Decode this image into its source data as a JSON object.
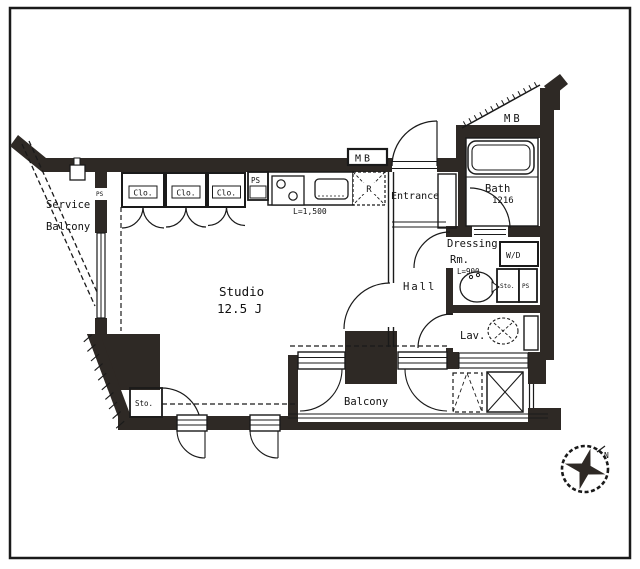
{
  "plan": {
    "labels": {
      "service_line1": "Service",
      "service_line2": "Balcony",
      "closet": "Clo.",
      "pipe_space": "PS",
      "meter_box": "MB",
      "kitchen_length": "L=1,500",
      "refrigerator": "R",
      "entrance": "Entrance",
      "bath": "Bath",
      "bath_size": "1216",
      "dressing_line1": "Dressing",
      "dressing_line2": "Rm.",
      "dressing_length": "L=900",
      "washer_dryer": "W/D",
      "storage": "Sto.",
      "hall": "Hall",
      "lavatory": "Lav.",
      "studio": "Studio",
      "studio_area": "12.5 J",
      "balcony": "Balcony",
      "north": "N"
    },
    "colors": {
      "wall": "#2e2925",
      "line": "#1a1a1a",
      "shade": "#ccdcdf",
      "background": "#ffffff"
    }
  }
}
